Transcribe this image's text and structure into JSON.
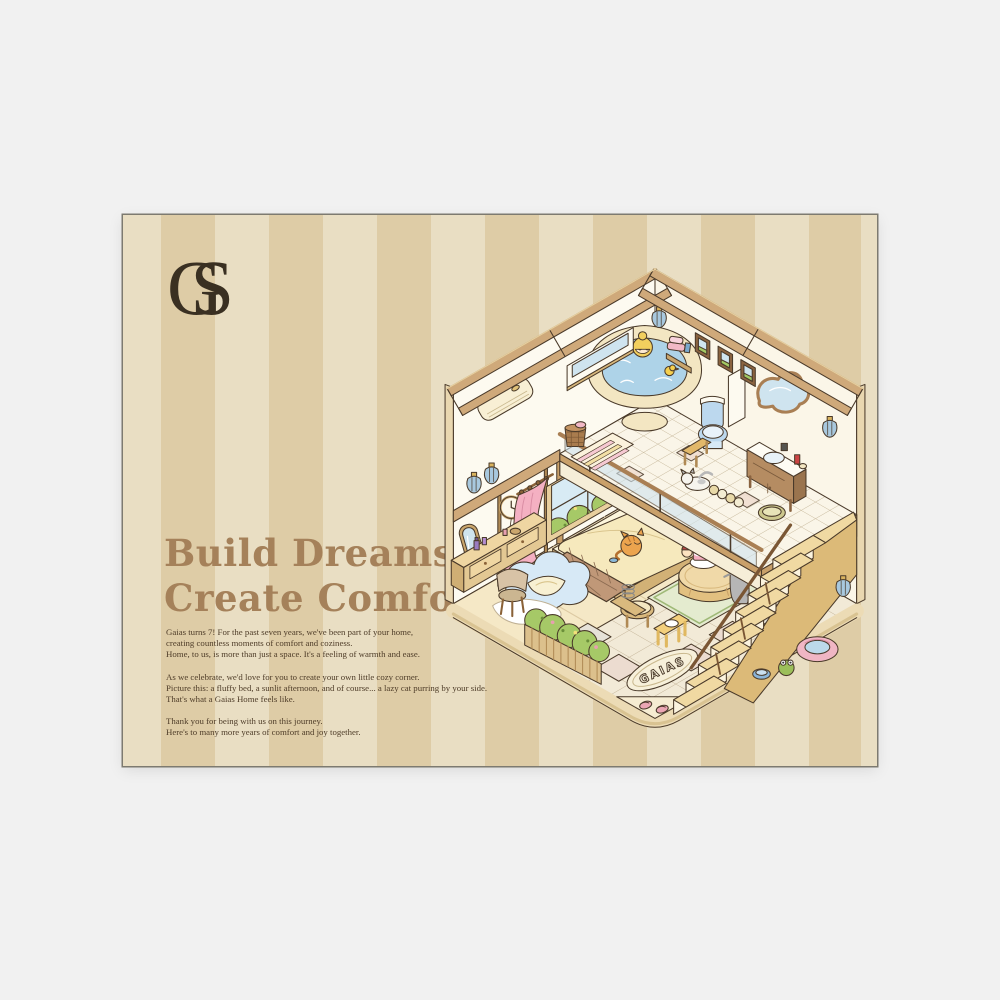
{
  "page": {
    "background_color": "#f1f1f1"
  },
  "poster": {
    "stripe_light": "#e9dec3",
    "stripe_dark": "#decca6",
    "accent_brown": "#a5815a",
    "text_brown": "#4e3c28",
    "logo": {
      "letter_g": "G",
      "letter_s": "S"
    },
    "title": {
      "lines": [
        "Build Dreams,",
        "Create Comfort"
      ]
    },
    "body": {
      "paragraphs": [
        [
          "Gaias turns 7! For the past seven years, we've been part of your home,",
          "creating countless moments of comfort and coziness.",
          "Home, to us, is more than just a space. It's a feeling of warmth and ease."
        ],
        [
          "As we celebrate, we'd love for you to create your own little cozy corner.",
          "Picture this: a fluffy bed, a sunlit afternoon, and of course... a lazy cat purring by your side.",
          "That's what a Gaias Home feels like."
        ],
        [
          "Thank you for being with us on this journey.",
          "Here's to many more years of comfort and joy together."
        ]
      ]
    },
    "illustration": {
      "rug_text": "GAIAS"
    }
  }
}
